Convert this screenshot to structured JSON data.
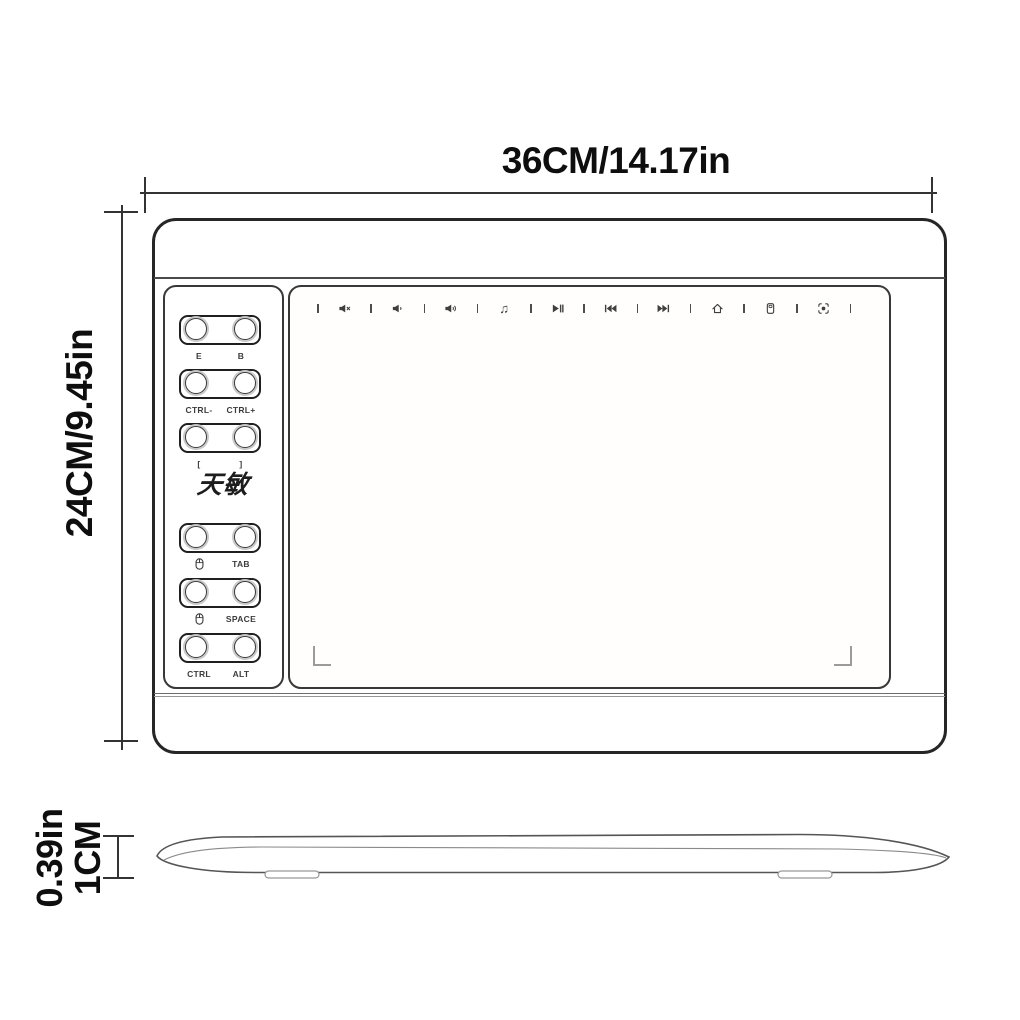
{
  "top_dimension": {
    "label": "36CM/14.17in"
  },
  "left_dimension": {
    "label": "24CM/9.45in"
  },
  "thickness_dimension": {
    "label_in": "0.39in",
    "label_cm": "1CM"
  },
  "tablet": {
    "brand_logo": "天敏",
    "media_bar": {
      "icons": [
        "mute-icon",
        "volume-down-icon",
        "volume-up-icon",
        "music-icon",
        "play-pause-icon",
        "previous-track-icon",
        "next-track-icon",
        "home-icon",
        "calculator-icon",
        "record-icon"
      ]
    },
    "express_keys": [
      {
        "left_label": "E",
        "right_label": "B"
      },
      {
        "left_label": "CTRL-",
        "right_label": "CTRL+"
      },
      {
        "left_label": "[",
        "right_label": "]"
      },
      {
        "left_label": "mouse-icon",
        "left_is_icon": true,
        "right_label": "TAB"
      },
      {
        "left_label": "mouse-icon",
        "left_is_icon": true,
        "right_label": "SPACE"
      },
      {
        "left_label": "CTRL",
        "right_label": "ALT"
      }
    ]
  },
  "colors": {
    "outline": "#262626",
    "panel_outline": "#383838",
    "dimension_line": "#333333",
    "icon": "#3f3f3f",
    "corner_mark": "#9b9b9b"
  }
}
